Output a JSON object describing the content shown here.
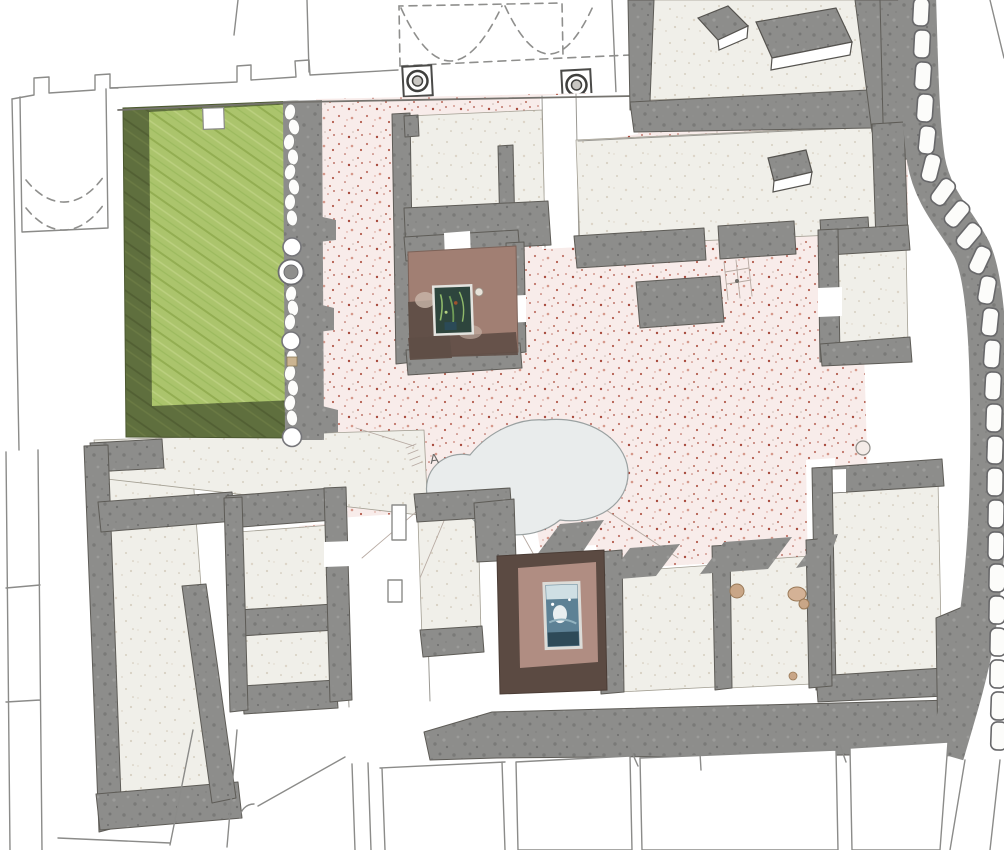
{
  "meta": {
    "description": "Watercolor archaeological excavation plan of a Roman house with garden, stippled courtyard, mosaic fountain rooms and city wall"
  },
  "annotations": {
    "pool_mark": "A"
  },
  "colors": {
    "background": "#ffffff",
    "ink_outline": "#8b8b89",
    "wall_gray": "#8d8d8b",
    "wall_speck_dark": "#7a7a78",
    "wall_speck_light": "#9c9c9a",
    "floor_beige": "#f0efe9",
    "floor_speck": "#d7d0c2",
    "courtyard_pink": "#f8ecea",
    "stipple_red": "#b35c4d",
    "stipple_red_light": "#d5988a",
    "garden_green": "#abc46c",
    "garden_stroke_dark": "#93ae52",
    "garden_stroke_light": "#bcd080",
    "garden_shadow": "#5f6f3e",
    "garden_shadow_stroke": "#525f33",
    "room_brown_dark": "#5b4a42",
    "room_mauve": "#b08d82",
    "room_upper_floor": "#a17f73",
    "mosaic_teal": "#2e453d",
    "mosaic_blue": "#5d8195",
    "mosaic_light": "#cfdfe4",
    "pool_gray": "#e9ecec",
    "stone_white": "#fcfcfa",
    "object_tan": "#c9a687"
  }
}
